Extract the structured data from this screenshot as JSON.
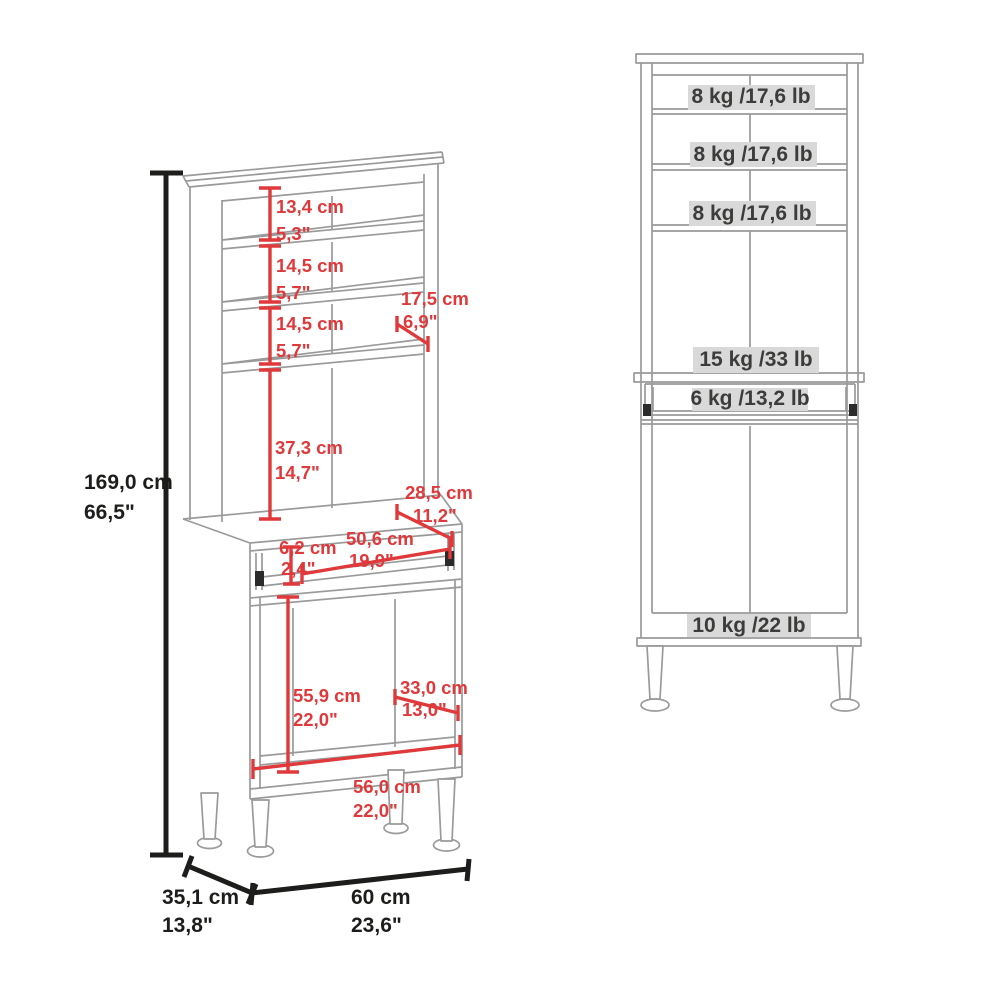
{
  "colors": {
    "dimension_red": "#e0393b",
    "line_gray": "#9a9a9a",
    "dimension_black": "#1d1d1b",
    "capacity_label_bg": "#d9d9d9",
    "capacity_label_text": "#3c3c3b"
  },
  "left_view": {
    "overall_height": {
      "cm": "169,0 cm",
      "inch": "66,5\""
    },
    "top_gap": {
      "cm": "13,4 cm",
      "inch": "5,3\""
    },
    "shelf_gap_1": {
      "cm": "14,5 cm",
      "inch": "5,7\""
    },
    "shelf_gap_2": {
      "cm": "14,5 cm",
      "inch": "5,7\""
    },
    "shelf_depth": {
      "cm": "17,5 cm",
      "inch": "6,9\""
    },
    "hutch_opening": {
      "cm": "37,3 cm",
      "inch": "14,7\""
    },
    "counter_depth": {
      "cm": "28,5 cm",
      "inch": "11,2\""
    },
    "tray_height": {
      "cm": "6,2 cm",
      "inch": "2,4\""
    },
    "tray_width": {
      "cm": "50,6 cm",
      "inch": "19,9\""
    },
    "cabinet_opening_height": {
      "cm": "55,9 cm",
      "inch": "22,0\""
    },
    "cabinet_depth": {
      "cm": "33,0 cm",
      "inch": "13,0\""
    },
    "cabinet_width": {
      "cm": "56,0 cm",
      "inch": "22,0\""
    },
    "base_depth": {
      "cm": "35,1 cm",
      "inch": "13,8\""
    },
    "base_width": {
      "cm": "60 cm",
      "inch": "23,6\""
    }
  },
  "right_view": {
    "capacities": {
      "shelf_1": "8 kg /17,6 lb",
      "shelf_2": "8 kg /17,6 lb",
      "shelf_3": "8 kg /17,6 lb",
      "counter": "15 kg /33 lb",
      "tray": "6 kg /13,2 lb",
      "cabinet": "10 kg /22 lb"
    }
  }
}
